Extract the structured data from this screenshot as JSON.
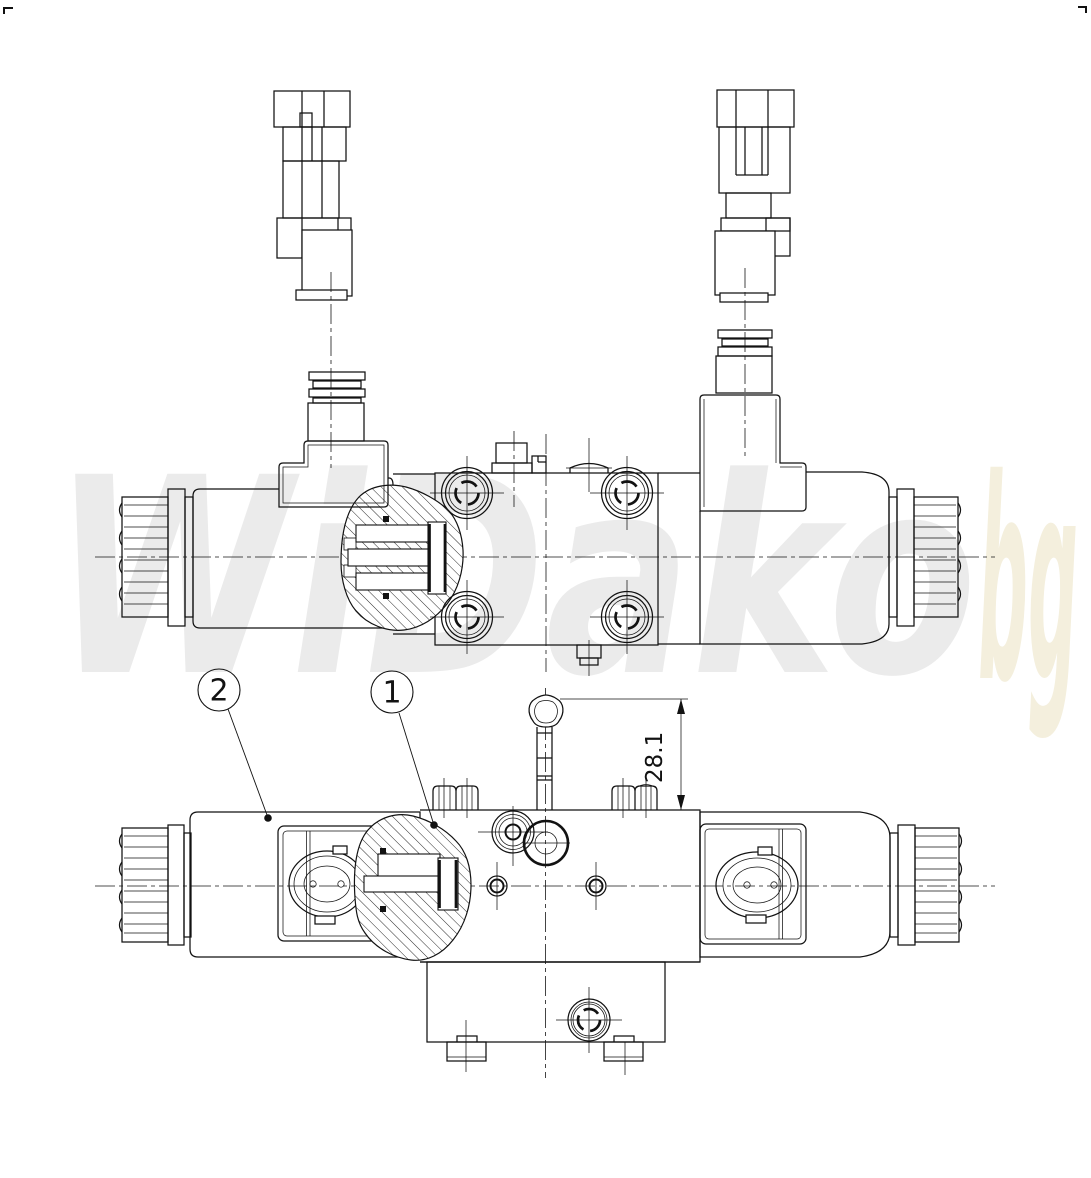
{
  "watermark": {
    "text": "WiDako",
    "suffix": "bg",
    "color": "#ebebeb",
    "suffix_color": "#f4efdd"
  },
  "balloons": [
    {
      "label": "2"
    },
    {
      "label": "1"
    }
  ],
  "dimension": {
    "value": "28.1"
  },
  "drawing": {
    "line_color": "#121212",
    "background": "#ffffff"
  }
}
